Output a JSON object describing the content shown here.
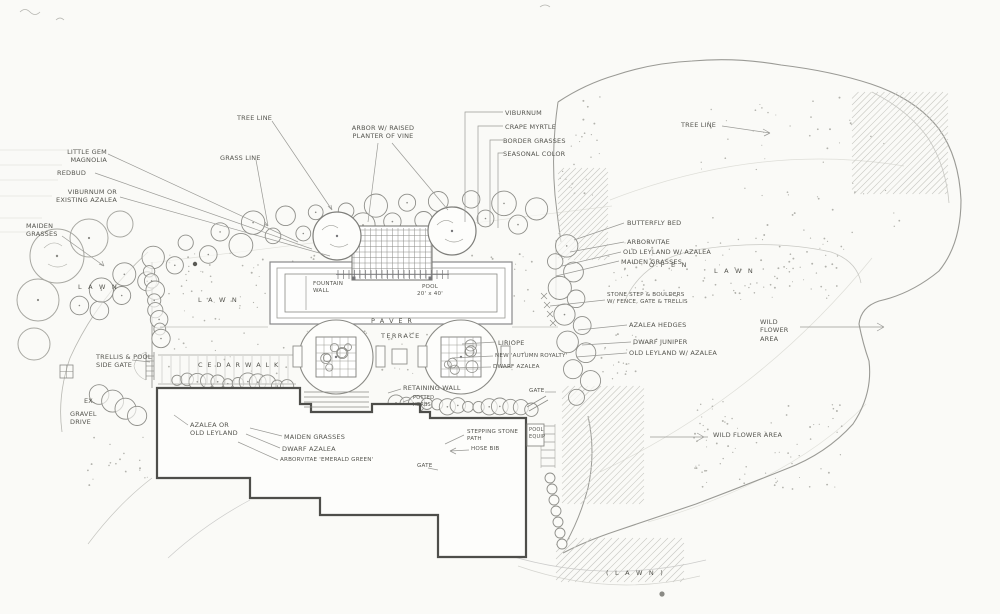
{
  "colors": {
    "paper": "#fafaf7",
    "pencil": "#8a8a86",
    "ink": "#55554f",
    "dark_outline": "#4e4e4a"
  },
  "labels": {
    "little_gem": "LITTLE GEM\nMAGNOLIA",
    "redbud": "REDBUD",
    "viburnum_existing": "VIBURNUM OR\nEXISTING AZALEA",
    "maiden_left": "MAIDEN\nGRASSES",
    "tree_line_left": "TREE LINE",
    "grass_line": "GRASS LINE",
    "arbor": "ARBOR W/ RAISED\nPLANTER OF VINE",
    "viburnum_top": "VIBURNUM",
    "crape_myrtle": "CRAPE MYRTLE",
    "border_grasses": "BORDER GRASSES",
    "seasonal_color": "SEASONAL COLOR",
    "tree_line_right": "TREE LINE",
    "butterfly_bed": "BUTTERFLY BED",
    "arborvitae": "ARBORVITAE",
    "old_leyland_azalea_1": "OLD LEYLAND W/ AZALEA",
    "maiden_right": "MAIDEN GRASSES",
    "open": "O P E N",
    "lawn_right": "L A W N",
    "stone_step": "STONE STEP & BOULDERS\nW/ FENCE, GATE & TRELLIS",
    "azalea_hedges": "AZALEA HEDGES",
    "dwarf_juniper": "DWARF JUNIPER",
    "old_leyland_azalea_2": "OLD LEYLAND W/ AZALEA",
    "wild_flower_area_1": "WILD\nFLOWER\nAREA",
    "wild_flower_area_2": "WILD FLOWER AREA",
    "fountain_wall": "FOUNTAIN\nWALL",
    "pool": "POOL\n20' x 40'",
    "paver": "P A V E R",
    "terrace": "TERRACE",
    "liriope": "LIRIOPE",
    "new_autumn": "NEW 'AUTUMN ROYALTY'",
    "dwarf_azalea_center": "DWARF AZALEA",
    "retaining_wall": "RETAINING WALL",
    "potted_herbs": "POTTED\nHERBS",
    "gate_upper": "GATE",
    "pool_equip": "POOL\nEQUIP",
    "stepping_stone_path": "STEPPING STONE\nPATH",
    "hose_bib": "HOSE BIB",
    "gate_lower": "GATE",
    "azalea_old_leyland": "AZALEA OR\nOLD LEYLAND",
    "maiden_bottom": "MAIDEN GRASSES",
    "dwarf_azalea_bottom": "DWARF AZALEA",
    "arborvitae_emerald": "ARBORVITAE 'EMERALD GREEN'",
    "trellis_gate": "TRELLIS & POOL\nSIDE GATE",
    "cedar_walk": "C E D A R   W A L K",
    "ex": "EX.",
    "gravel_drive": "GRAVEL\nDRIVE",
    "lawn_left_1": "L A W N",
    "lawn_left_2": "L A W N",
    "lawn_bottom": "( L A W N )"
  }
}
